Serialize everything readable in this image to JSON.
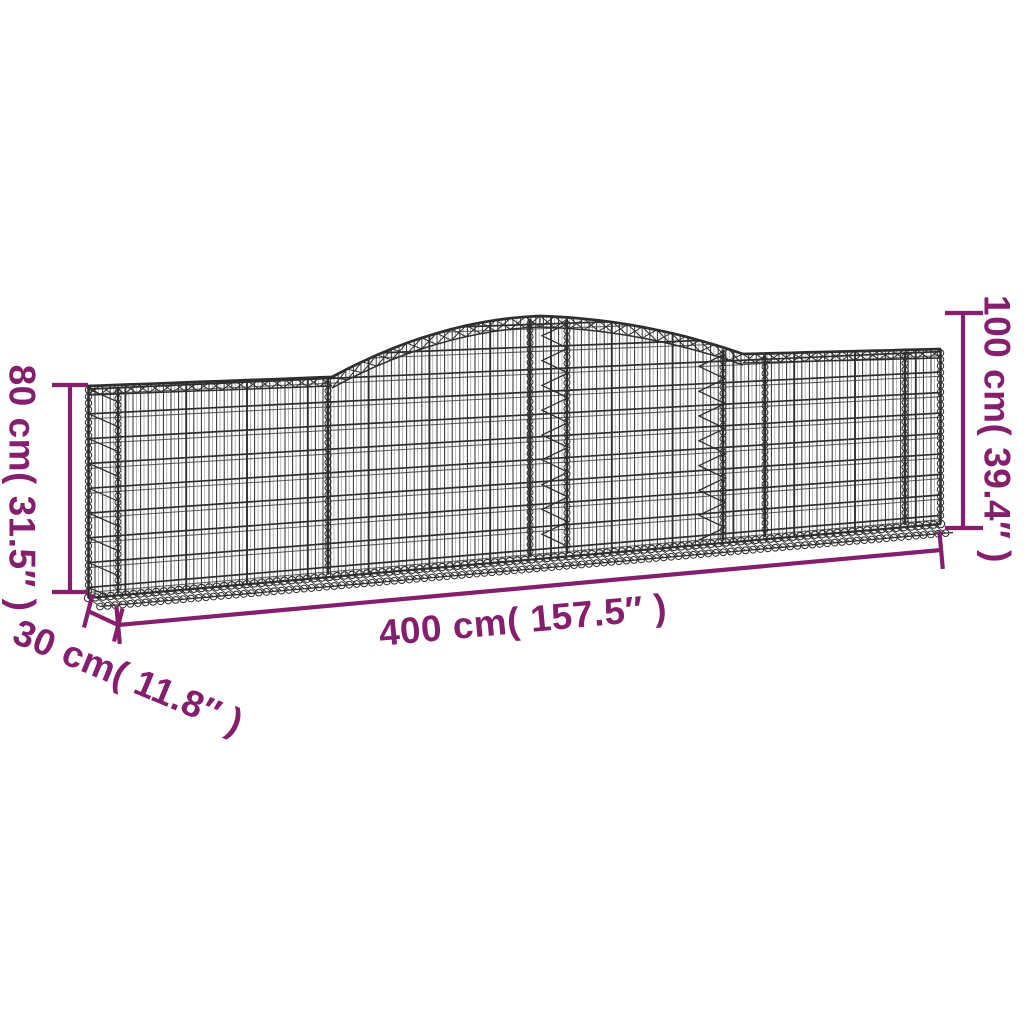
{
  "page": {
    "type": "product-dimension-diagram",
    "subject": "arched gabion wire mesh basket",
    "background": "#ffffff"
  },
  "colors": {
    "wire": "#2e2e2e",
    "dimension": "#851e6c",
    "background": "#ffffff"
  },
  "dimensions": {
    "left_height": {
      "label": "80 cm( 31.5″ )",
      "value_cm": 80,
      "value_in": 31.5
    },
    "right_height": {
      "label": "100 cm( 39.4″ )",
      "value_cm": 100,
      "value_in": 39.4
    },
    "width": {
      "label": "400 cm( 157.5″ )",
      "value_cm": 400,
      "value_in": 157.5
    },
    "depth": {
      "label": "30 cm( 11.8″ )",
      "value_cm": 30,
      "value_in": 11.8
    }
  }
}
